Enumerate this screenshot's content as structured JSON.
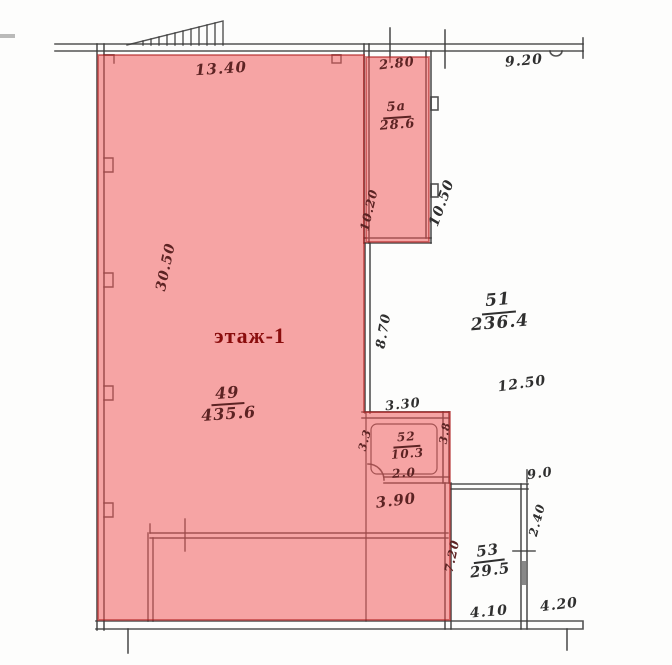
{
  "title": "Поэтажный план — этаж 1",
  "floor_label": "этаж-1",
  "colors": {
    "background": "#fdfdfc",
    "ink": "#2f2f2f",
    "ink_on_highlight": "#5c2323",
    "floor_label_color": "#8a0d0d",
    "highlight_fill": "rgba(240,82,82,0.52)",
    "highlight_edge": "rgba(173,28,28,0.6)"
  },
  "rooms": [
    {
      "num": "5а",
      "area": "28.6",
      "x": 397,
      "y": 117,
      "rot": -4,
      "size": 13,
      "tone": "pink"
    },
    {
      "num": "49",
      "area": "435.6",
      "x": 228,
      "y": 404,
      "rot": -4,
      "size": 16,
      "tone": "pink"
    },
    {
      "num": "51",
      "area": "236.4",
      "x": 499,
      "y": 312,
      "rot": -5,
      "size": 17,
      "tone": "ink"
    },
    {
      "num": "52",
      "area": "10.3",
      "x": 407,
      "y": 446,
      "rot": -4,
      "size": 12,
      "tone": "pink"
    },
    {
      "num": "53",
      "area": "29.5",
      "x": 489,
      "y": 561,
      "rot": -7,
      "size": 15,
      "tone": "ink"
    }
  ],
  "labels": [
    {
      "text": "13.40",
      "x": 221,
      "y": 69,
      "rot": -4,
      "size": 15,
      "tone": "pink"
    },
    {
      "text": "2.80",
      "x": 397,
      "y": 64,
      "rot": -6,
      "size": 13,
      "tone": "pink"
    },
    {
      "text": "9.20",
      "x": 524,
      "y": 61,
      "rot": -5,
      "size": 14,
      "tone": "ink"
    },
    {
      "text": "10.20",
      "x": 369,
      "y": 210,
      "rot": -77,
      "size": 12,
      "tone": "pink"
    },
    {
      "text": "10.50",
      "x": 442,
      "y": 203,
      "rot": -70,
      "size": 14,
      "tone": "ink"
    },
    {
      "text": "30.50",
      "x": 166,
      "y": 267,
      "rot": -78,
      "size": 14,
      "tone": "pink"
    },
    {
      "text": "8.70",
      "x": 384,
      "y": 331,
      "rot": -80,
      "size": 13,
      "tone": "ink"
    },
    {
      "text": "12.50",
      "x": 522,
      "y": 384,
      "rot": -8,
      "size": 14,
      "tone": "ink"
    },
    {
      "text": "3.30",
      "x": 403,
      "y": 405,
      "rot": -6,
      "size": 13,
      "tone": "ink"
    },
    {
      "text": "3.3",
      "x": 365,
      "y": 440,
      "rot": -75,
      "size": 11,
      "tone": "pink"
    },
    {
      "text": "3.8",
      "x": 445,
      "y": 433,
      "rot": -80,
      "size": 11,
      "tone": "pink"
    },
    {
      "text": "2.0",
      "x": 404,
      "y": 473,
      "rot": -4,
      "size": 12,
      "tone": "pink"
    },
    {
      "text": "3.90",
      "x": 396,
      "y": 501,
      "rot": -7,
      "size": 15,
      "tone": "pink"
    },
    {
      "text": "9.0",
      "x": 540,
      "y": 474,
      "rot": -8,
      "size": 13,
      "tone": "ink"
    },
    {
      "text": "2.40",
      "x": 537,
      "y": 520,
      "rot": -75,
      "size": 12,
      "tone": "ink"
    },
    {
      "text": "7.20",
      "x": 452,
      "y": 556,
      "rot": -78,
      "size": 12,
      "tone": "pink"
    },
    {
      "text": "4.10",
      "x": 489,
      "y": 612,
      "rot": -5,
      "size": 14,
      "tone": "ink"
    },
    {
      "text": "4.20",
      "x": 559,
      "y": 605,
      "rot": -7,
      "size": 14,
      "tone": "ink"
    }
  ]
}
